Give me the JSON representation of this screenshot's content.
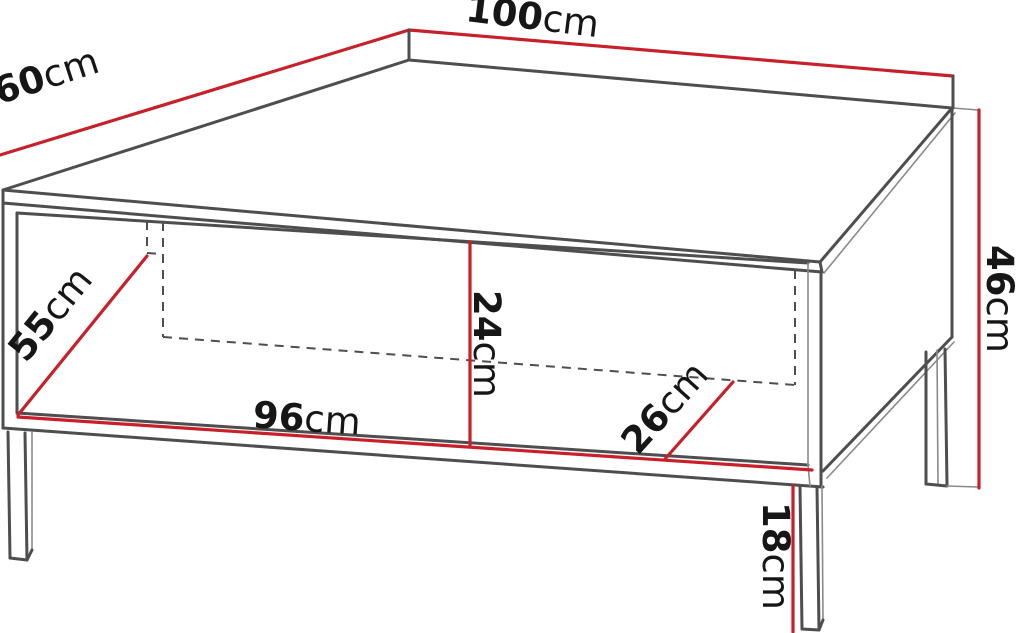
{
  "diagram": {
    "type": "furniture-dimension-drawing",
    "subject": "coffee-table-3d-line-drawing",
    "unit": "cm",
    "dimensions": {
      "top_width": {
        "value": "100",
        "unit": "cm"
      },
      "top_depth": {
        "value": "60",
        "unit": "cm"
      },
      "total_height": {
        "value": "46",
        "unit": "cm"
      },
      "interior_diagonal": {
        "value": "55",
        "unit": "cm"
      },
      "interior_width": {
        "value": "96",
        "unit": "cm"
      },
      "interior_height": {
        "value": "24",
        "unit": "cm"
      },
      "interior_depth": {
        "value": "26",
        "unit": "cm"
      },
      "leg_height": {
        "value": "18",
        "unit": "cm"
      }
    },
    "colors": {
      "dimension_line": "#c8202a",
      "outline": "#4e4e4e",
      "thin_line": "#8a8a8a",
      "label_text": "#161616",
      "background": "#ffffff"
    }
  }
}
